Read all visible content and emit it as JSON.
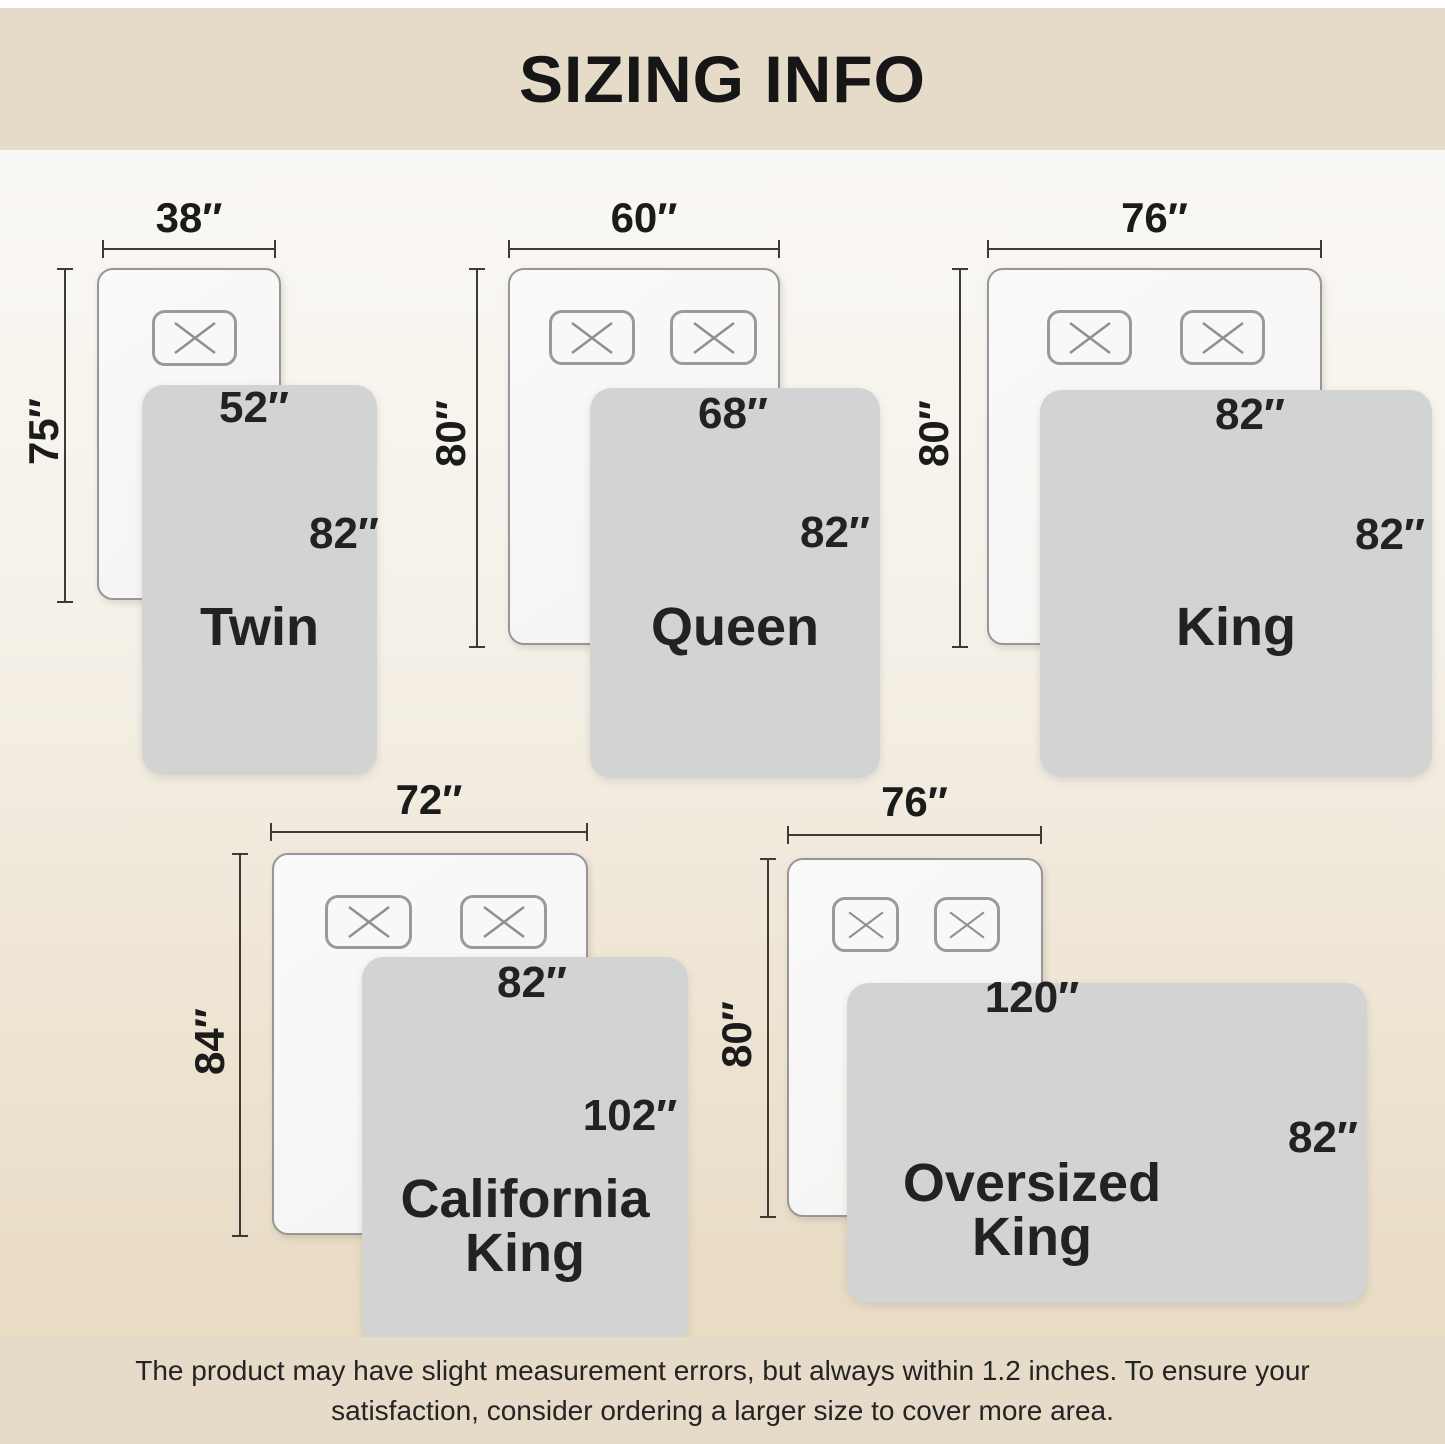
{
  "title": "SIZING INFO",
  "footer": {
    "lines": [
      "The product may have slight measurement errors, but always within 1.2 inches. To ensure your",
      "satisfaction, consider ordering a larger size to cover more area."
    ]
  },
  "sizes": [
    {
      "name": "Twin",
      "bed_width": "38″",
      "bed_length": "75″",
      "blanket_width": "52″",
      "blanket_length": "82″"
    },
    {
      "name": "Queen",
      "bed_width": "60″",
      "bed_length": "80″",
      "blanket_width": "68″",
      "blanket_length": "82″"
    },
    {
      "name": "King",
      "bed_width": "76″",
      "bed_length": "80″",
      "blanket_width": "82″",
      "blanket_length": "82″"
    },
    {
      "name": "California King",
      "bed_width": "72″",
      "bed_length": "84″",
      "blanket_width": "82″",
      "blanket_length": "102″"
    },
    {
      "name": "Oversized King",
      "bed_width": "76″",
      "bed_length": "80″",
      "blanket_width": "120″",
      "blanket_length": "82″"
    }
  ],
  "colors": {
    "band_bg": "#e5dbc8",
    "blanket_bg": "#d2d3d3",
    "bed_border": "#97979a",
    "dimension_line": "#3b3b3b",
    "text": "#1e1e1e"
  }
}
